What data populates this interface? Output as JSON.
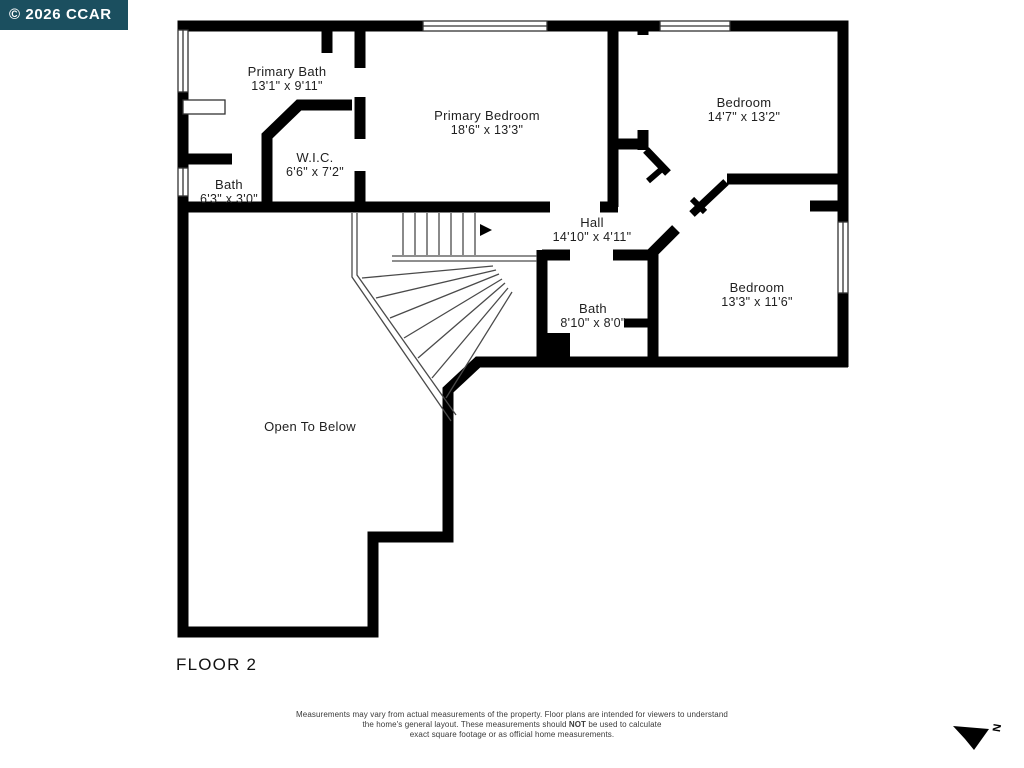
{
  "watermark": {
    "text": "© 2026 CCAR"
  },
  "floor_label": "FLOOR 2",
  "rooms": [
    {
      "name": "Primary Bath",
      "dims": "13'1\" x 9'11\""
    },
    {
      "name": "Primary Bedroom",
      "dims": "18'6\" x 13'3\""
    },
    {
      "name": "Bedroom",
      "dims": "14'7\" x 13'2\""
    },
    {
      "name": "W.I.C.",
      "dims": "6'6\" x 7'2\""
    },
    {
      "name": "Bath",
      "dims": "6'3\" x 3'0\""
    },
    {
      "name": "Hall",
      "dims": "14'10\" x 4'11\""
    },
    {
      "name": "Bath",
      "dims": "8'10\" x 8'0\""
    },
    {
      "name": "Bedroom",
      "dims": "13'3\" x 11'6\""
    },
    {
      "name": "Open To Below",
      "dims": ""
    }
  ],
  "disclaimer": {
    "line1": "Measurements may vary from actual measurements of the property. Floor plans are intended for viewers to understand",
    "line2_pre": "the home's general layout.  These measurements should ",
    "line2_bold": "NOT",
    "line2_post": " be used to calculate",
    "line3": "exact square footage or as official home measurements."
  },
  "compass": {
    "letter": "N"
  },
  "colors": {
    "wall": "#000000",
    "badge_bg": "#1b4f5f",
    "badge_text": "#ffffff"
  }
}
